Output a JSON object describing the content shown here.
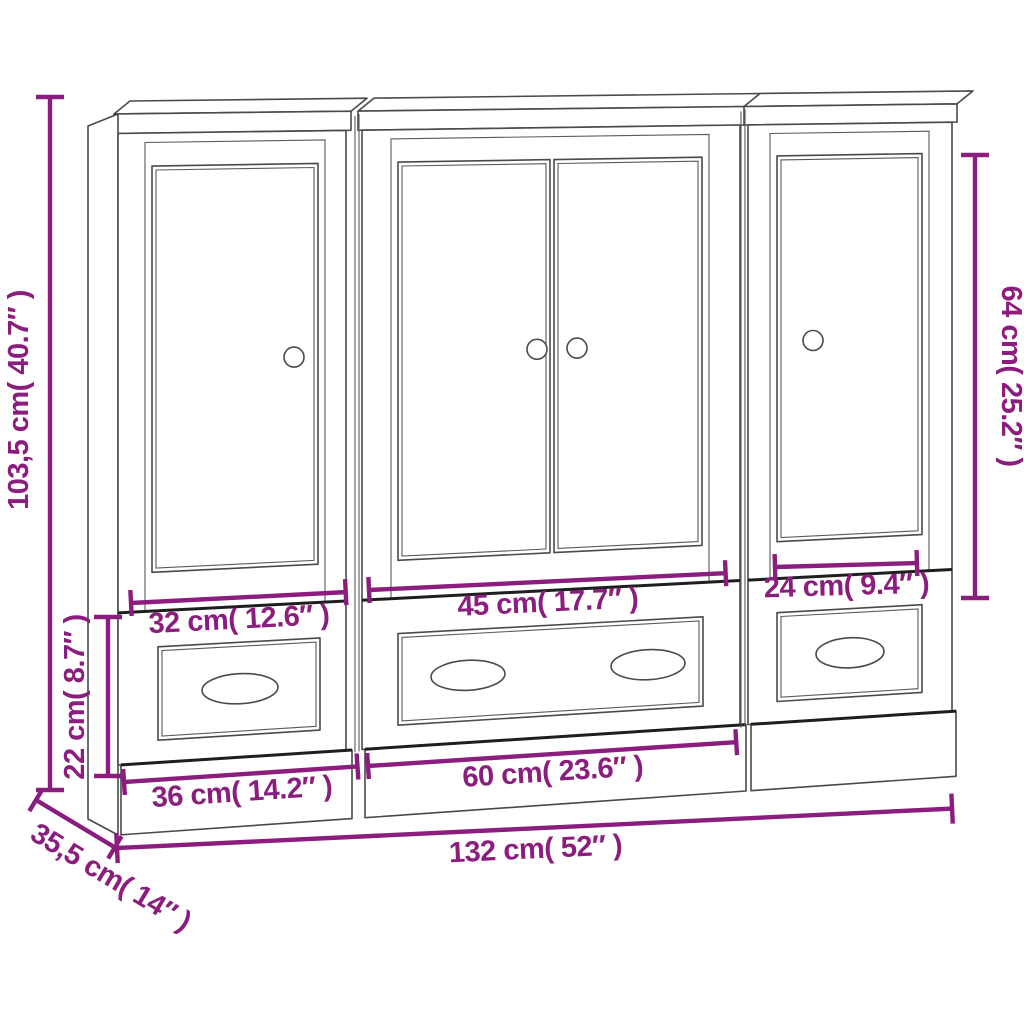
{
  "diagram": {
    "kind": "furniture-dimension-diagram",
    "background": "#ffffff",
    "accent_color": "#8B1D7E",
    "outline_color": "#4a4a4a",
    "cabinets": [
      {
        "position": "left",
        "doors": 1,
        "door_knobs": 1,
        "drawers": 1,
        "drawer_handles": 1
      },
      {
        "position": "middle",
        "doors": 2,
        "door_knobs": 2,
        "drawers": 1,
        "drawer_handles": 2
      },
      {
        "position": "right",
        "doors": 1,
        "door_knobs": 1,
        "drawers": 1,
        "drawer_handles": 1
      }
    ]
  },
  "dimensions": {
    "total_height": {
      "cm": "103,5",
      "inches": "40.7",
      "label": "103,5 cm( 40.7″ )"
    },
    "base_section_height": {
      "cm": "22",
      "inches": "8.7",
      "label": "22 cm( 8.7″ )"
    },
    "right_door_height": {
      "cm": "64",
      "inches": "25.2",
      "label": "64 cm( 25.2″ )"
    },
    "left_door_width": {
      "cm": "32",
      "inches": "12.6",
      "label": "32 cm( 12.6″ )"
    },
    "middle_doors_width": {
      "cm": "45",
      "inches": "17.7",
      "label": "45 cm( 17.7″ )"
    },
    "right_door_width": {
      "cm": "24",
      "inches": "9.4",
      "label": "24 cm( 9.4″ )"
    },
    "left_unit_width": {
      "cm": "36",
      "inches": "14.2",
      "label": "36 cm( 14.2″ )"
    },
    "middle_unit_width": {
      "cm": "60",
      "inches": "23.6",
      "label": "60 cm( 23.6″ )"
    },
    "total_width": {
      "cm": "132",
      "inches": "52",
      "label": "132 cm( 52″ )"
    },
    "depth": {
      "cm": "35,5",
      "inches": "14",
      "label": "35,5 cm( 14″ )"
    }
  }
}
